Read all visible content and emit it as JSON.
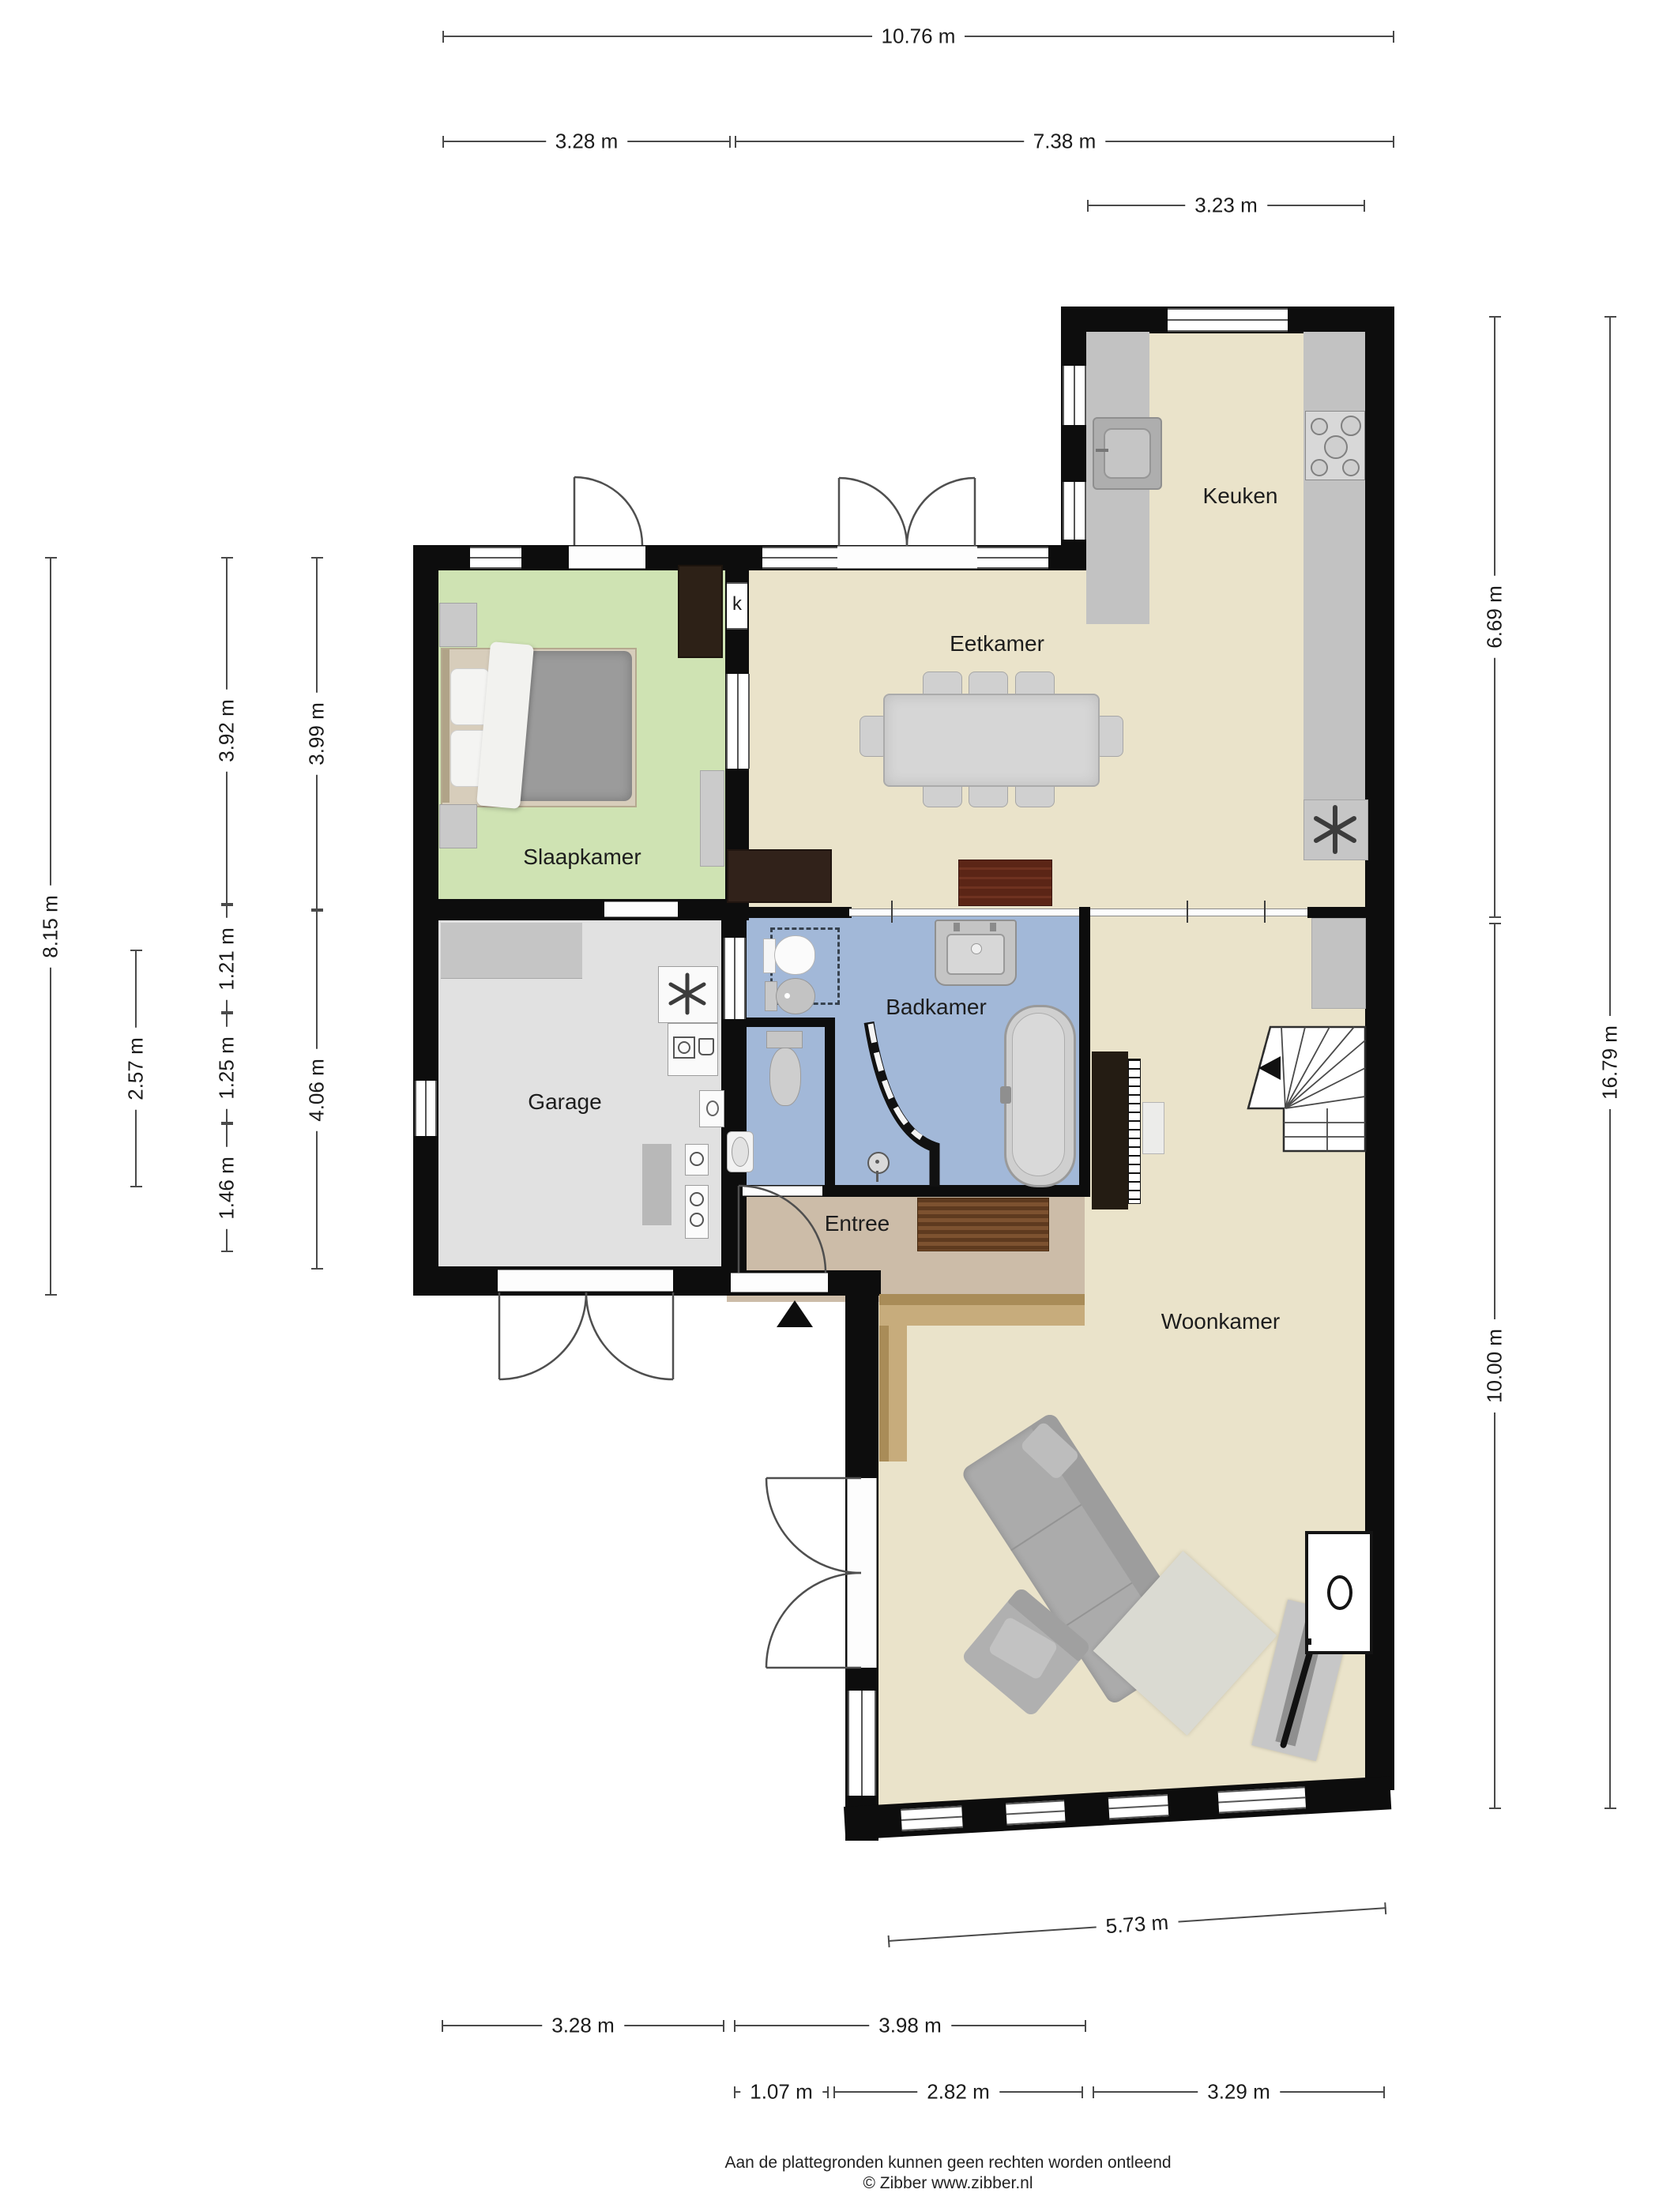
{
  "rooms": {
    "keuken": "Keuken",
    "eetkamer": "Eetkamer",
    "slaapkamer": "Slaapkamer",
    "badkamer": "Badkamer",
    "garage": "Garage",
    "entree": "Entree",
    "woonkamer": "Woonkamer",
    "closet": "k"
  },
  "dims": {
    "top_total": "10.76 m",
    "top_left": "3.28 m",
    "top_right": "7.38 m",
    "top_kitchen": "3.23 m",
    "left_total": "8.15 m",
    "left_mid": "2.57 m",
    "left_c3_a": "3.92 m",
    "left_c3_b": "1.21 m",
    "left_c3_c": "1.25 m",
    "left_c3_d": "1.46 m",
    "left_c4_a": "3.99 m",
    "left_c4_b": "4.06 m",
    "right_top": "6.69 m",
    "right_total": "16.79 m",
    "right_bottom": "10.00 m",
    "bottom_wall": "5.73 m",
    "bottom_a1": "3.28 m",
    "bottom_a2": "3.98 m",
    "bottom_b1": "1.07 m",
    "bottom_b2": "2.82 m",
    "bottom_b3": "3.29 m"
  },
  "footer": {
    "line1": "Aan de plattegronden kunnen geen rechten worden ontleend",
    "line2": "© Zibber www.zibber.nl"
  },
  "colors": {
    "wall": "#0d0d0d",
    "floor_beige": "#eae3ca",
    "floor_green": "#cfe3b3",
    "floor_blue": "#a2b8d8",
    "floor_garage": "#e1e1e1",
    "floor_entree": "#ccbca8",
    "wood_step": "#b09058",
    "counter_gray": "#c2c2c2",
    "dim_line": "#4a4a4a"
  }
}
